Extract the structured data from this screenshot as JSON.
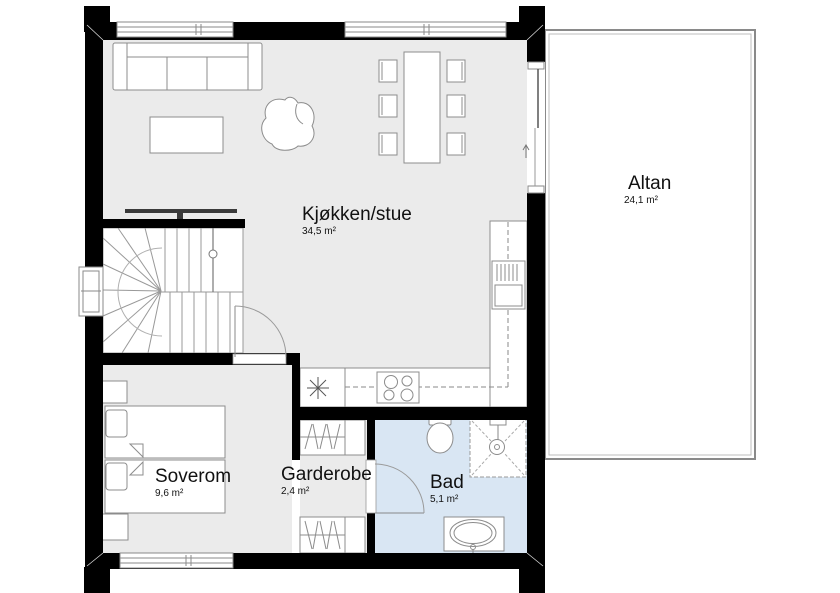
{
  "document": {
    "type": "floor-plan",
    "style": "architectural top-down plan"
  },
  "rooms": [
    {
      "id": "kjokken-stue",
      "name": "Kjøkken/stue",
      "area": "34,5 m²"
    },
    {
      "id": "altan",
      "name": "Altan",
      "area": "24,1 m²"
    },
    {
      "id": "soverom",
      "name": "Soverom",
      "area": "9,6 m²"
    },
    {
      "id": "garderobe",
      "name": "Garderobe",
      "area": "2,4 m²"
    },
    {
      "id": "bad",
      "name": "Bad",
      "area": "5,1 m²"
    }
  ],
  "symbols": {
    "stair": "winder-staircase",
    "sink_symbol": "asterisk-drain",
    "cooktop": "4-burner",
    "exit_arrow": "up-arrow-at-balcony-door"
  },
  "colors": {
    "wall": "#000000",
    "floor": "#ebebeb",
    "bathroom-floor": "#d9e6f3",
    "furniture-line": "#8c8c8c",
    "balcony-line": "#8a8a8a",
    "label-text": "#111111"
  }
}
